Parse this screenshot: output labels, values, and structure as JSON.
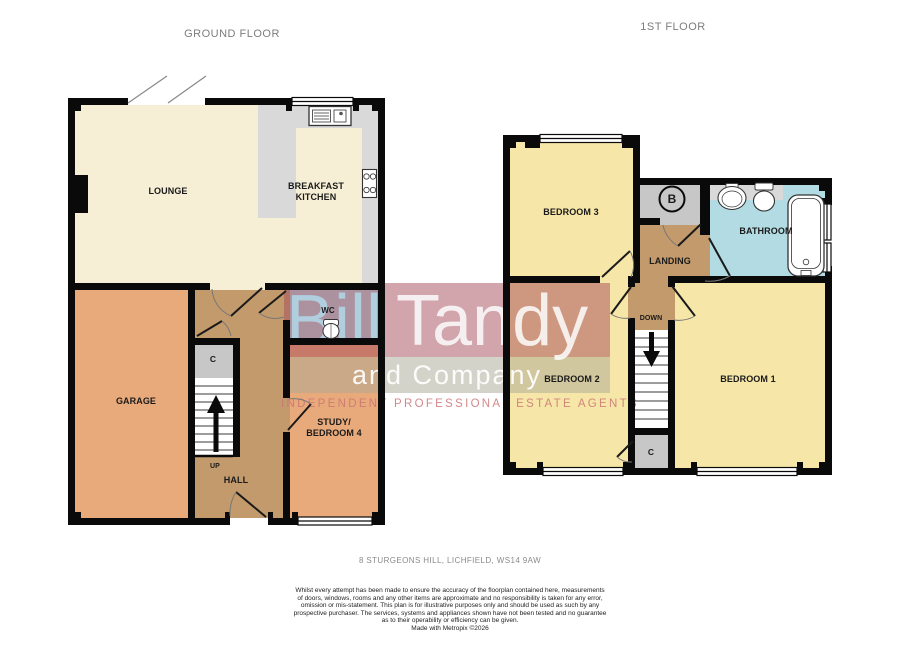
{
  "titles": {
    "ground": "GROUND FLOOR",
    "first": "1ST FLOOR"
  },
  "rooms": {
    "lounge": "LOUNGE",
    "kitchen": "BREAKFAST KITCHEN",
    "garage": "GARAGE",
    "wc": "WC",
    "hall": "HALL",
    "up": "UP",
    "c_ground": "C",
    "study": "STUDY/ BEDROOM 4",
    "bedroom3": "BEDROOM 3",
    "boiler": "B",
    "bathroom": "BATHROOM",
    "landing": "LANDING",
    "down": "DOWN",
    "bedroom2": "BEDROOM 2",
    "bedroom1": "BEDROOM 1",
    "c_first": "C"
  },
  "watermark": {
    "name_blue": "Bill",
    "name_rest": "Tandy",
    "subtitle": "and Company",
    "tagline": "INDEPENDENT PROFESSIONAL ESTATE AGENTS"
  },
  "footer": {
    "address": "8 STURGEONS HILL, LICHFIELD, WS14 9AW",
    "disclaimer": [
      "Whilst every attempt has been made to ensure the accuracy of the floorplan contained here, measurements",
      "of doors, windows, rooms and any other items are approximate and no responsibility is taken for any error,",
      "omission or mis-statement. This plan is for illustrative purposes only and should be used as such by any",
      "prospective purchaser. The services, systems and appliances shown have not been tested and no guarantee",
      "as to their operability or efficiency can be given."
    ],
    "made_with": "Made with Metropix ©2026"
  },
  "colors": {
    "room_cream": "#f6efd5",
    "counter_gray": "#d9d9d9",
    "room_orange": "#e9aa7b",
    "room_tan": "#c29a6c",
    "room_yellow": "#f6e6a7",
    "room_blue": "#b2dbe3",
    "room_gray": "#c7c7c7",
    "wall_black": "#0a0a0a"
  }
}
